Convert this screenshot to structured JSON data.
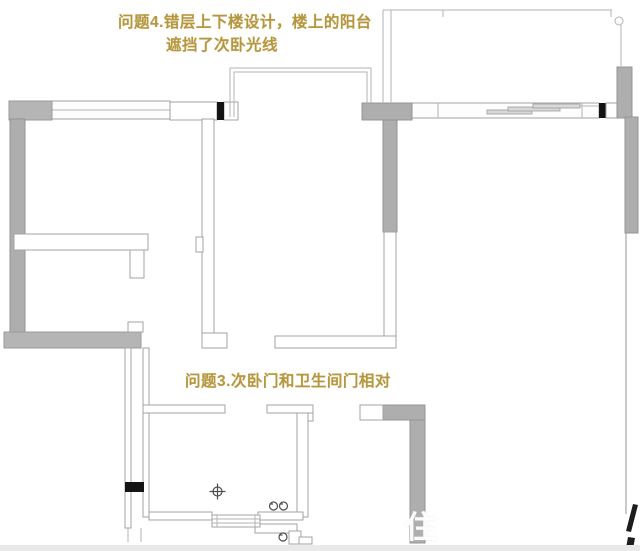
{
  "annotations": {
    "problem4_line1": "问题4.错层上下楼设计，楼上的阳台",
    "problem4_line2": "遮挡了次卧光线",
    "problem3": "问题3.次卧门和卫生间门相对",
    "text_color": "#b5973f"
  },
  "watermark": {
    "character": "住",
    "faint_character": "好"
  },
  "plan": {
    "type": "apartment-floor-plan",
    "icons": [
      "floor-drain-icon",
      "faucet-icon",
      "faucet-icon",
      "faucet-icon",
      "corner-circle-icon"
    ]
  },
  "colors": {
    "background": "#ffffff",
    "wall_gray": "#aeaeae",
    "wall_outline": "#a3a3a3",
    "wall_black": "#141414",
    "thin_line": "#a8a8a8",
    "annotation_gold": "#b5973f",
    "bottom_strip": "#e9e9e9"
  }
}
